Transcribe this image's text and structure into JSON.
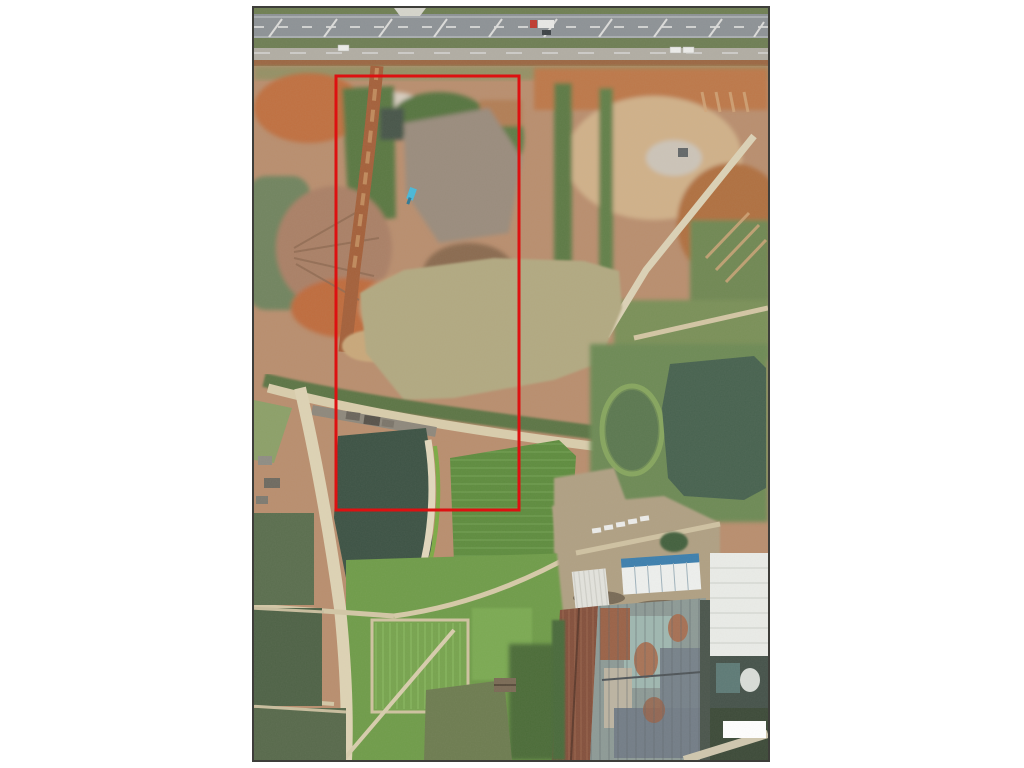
{
  "scene": {
    "type": "aerial-orthophoto",
    "photo": {
      "left": 252,
      "top": 6,
      "width": 518,
      "height": 756
    },
    "annotation": {
      "x": 82,
      "y": 68,
      "width": 183,
      "height": 434,
      "stroke": "#dd1111",
      "stroke_width": 3
    },
    "palette": {
      "page_bg": "#ffffff",
      "frame_border": "#3e3e3a",
      "grass_verge": "#6f7f53",
      "highway_asphalt": "#8d9296",
      "median_green": "#6e7e54",
      "service_road": "#b1ada3",
      "shoulder_dirt": "#9b6743",
      "bare_earth": "#b98e6e",
      "orange_soil": "#c0703f",
      "pale_soil": "#d7cdbf",
      "spoil_gray": "#9a8c7d",
      "scrub_green": "#5a7842",
      "murky_pond": "#71845f",
      "dirt_road": "#a4603a",
      "haul_road_sand": "#dcd2b6",
      "sediment_pond": "#b2a981",
      "dike_sand": "#d9cdac",
      "rubble_gray": "#8e887c",
      "levee_sand": "#ded3b4",
      "dark_pond": "#3c5244",
      "sand_bank": "#e2d8bd",
      "bright_field": "#5e8c3e",
      "oval_pond": "#5b7850",
      "big_pond": "#47624f",
      "pond_surround": "#6d8a55",
      "farmland": "#6f9c49",
      "farm_path": "#d3c7a6",
      "left_pond_1": "#5a6e4e",
      "left_pond_2": "#4e6246",
      "left_pond_3": "#57694b",
      "bottom_pond": "#6d7c50",
      "tree_band": "#4b6c38",
      "factory_yard": "#b0a083",
      "small_warehouse": "#e3e3dd",
      "container_white": "#eef0ee",
      "container_blue": "#3c7fae",
      "rust_roof": "#84503c",
      "patch_roof_base": "#8d9a96",
      "teal_roof": "#9fb7b0",
      "slate_roof": "#77828a",
      "white_roof": "#eaece8",
      "dark_section": "#45524a",
      "watermark": "#ffffff",
      "excavator_blue": "#49b8d8",
      "truck_red": "#bf3a30",
      "vehicle_white": "#ececea",
      "car_dark": "#3c4246"
    }
  }
}
